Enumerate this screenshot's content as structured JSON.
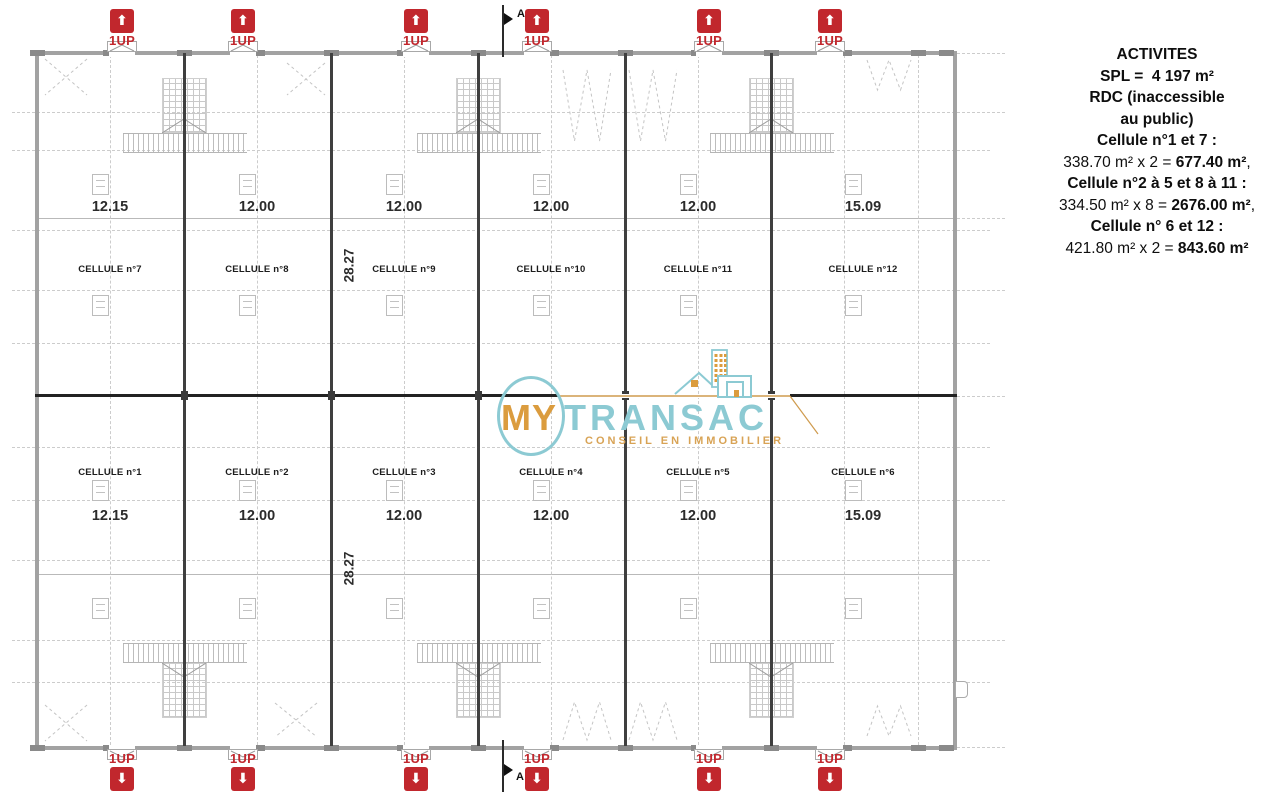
{
  "plan": {
    "stair_label": "1UP",
    "section_label": "A",
    "depth_dim": "28.27",
    "cells_top": [
      {
        "label": "CELLULE n°7",
        "dim": "12.15"
      },
      {
        "label": "CELLULE n°8",
        "dim": "12.00"
      },
      {
        "label": "CELLULE n°9",
        "dim": "12.00"
      },
      {
        "label": "CELLULE n°10",
        "dim": "12.00"
      },
      {
        "label": "CELLULE n°11",
        "dim": "12.00"
      },
      {
        "label": "CELLULE n°12",
        "dim": "15.09"
      }
    ],
    "cells_bottom": [
      {
        "label": "CELLULE n°1",
        "dim": "12.15"
      },
      {
        "label": "CELLULE n°2",
        "dim": "12.00"
      },
      {
        "label": "CELLULE n°3",
        "dim": "12.00"
      },
      {
        "label": "CELLULE n°4",
        "dim": "12.00"
      },
      {
        "label": "CELLULE n°5",
        "dim": "12.00"
      },
      {
        "label": "CELLULE n°6",
        "dim": "15.09"
      }
    ]
  },
  "logo": {
    "word1": "MY",
    "word2": "TRANSAC",
    "tagline": "CONSEIL EN IMMOBILIER"
  },
  "legend": {
    "lines": [
      {
        "segments": [
          {
            "text": "ACTIVITES",
            "bold": true
          }
        ]
      },
      {
        "segments": [
          {
            "text": "SPL =  4 197 m²",
            "bold": true
          }
        ]
      },
      {
        "segments": [
          {
            "text": "RDC (inaccessible",
            "bold": true
          }
        ]
      },
      {
        "segments": [
          {
            "text": "au public)",
            "bold": true
          }
        ]
      },
      {
        "segments": [
          {
            "text": "Cellule n°1 et 7 :",
            "bold": true
          }
        ]
      },
      {
        "segments": [
          {
            "text": "338.70 m² x 2 = ",
            "bold": false
          },
          {
            "text": "677.40 m²",
            "bold": true
          },
          {
            "text": ",",
            "bold": false
          }
        ]
      },
      {
        "segments": [
          {
            "text": "Cellule n°2 à 5 et 8 à 11 :",
            "bold": true
          }
        ]
      },
      {
        "segments": [
          {
            "text": "334.50 m² x 8 = ",
            "bold": false
          },
          {
            "text": "2676.00 m²",
            "bold": true
          },
          {
            "text": ",",
            "bold": false
          }
        ]
      },
      {
        "segments": [
          {
            "text": "Cellule n° 6 et 12 :",
            "bold": true
          }
        ]
      },
      {
        "segments": [
          {
            "text": "421.80 m² x 2 = ",
            "bold": false
          },
          {
            "text": "843.60 m²",
            "bold": true
          }
        ]
      }
    ]
  },
  "colors": {
    "red": "#c1272d",
    "teal": "#8ccad3",
    "orange": "#db9c3e",
    "tagline_orange": "#d8a355",
    "grid": "#cccccc"
  }
}
